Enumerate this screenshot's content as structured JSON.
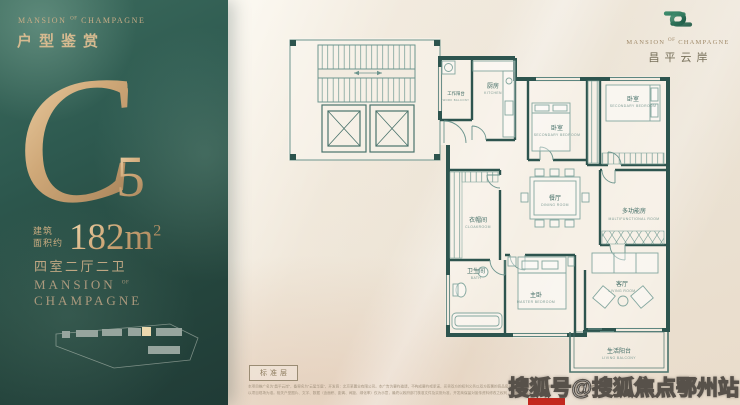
{
  "brand": {
    "left": "MANSION",
    "mid": "OF",
    "right": "CHAMPAGNE"
  },
  "sidebar": {
    "title": "户型鉴赏",
    "unit_letter": "C",
    "unit_number": "5",
    "area_label_line1": "建筑",
    "area_label_line2": "面积约",
    "area_value": "182m",
    "area_sup": "2",
    "layout_desc": "四室二厅二卫"
  },
  "logo": {
    "cn_name": "昌平云岸"
  },
  "floorplan": {
    "type_label": "标准层",
    "rooms": [
      {
        "cn": "工作阳台",
        "en": "WORK BALCONY"
      },
      {
        "cn": "厨房",
        "en": "KITCHEN"
      },
      {
        "cn": "卧室",
        "en": "SECONDARY BEDROOM"
      },
      {
        "cn": "卧室",
        "en": "SECONDARY BEDROOM"
      },
      {
        "cn": "衣帽间",
        "en": "CLOAKROOM"
      },
      {
        "cn": "餐厅",
        "en": "DINING ROOM"
      },
      {
        "cn": "多功能房",
        "en": "MULTIFUNCTIONAL ROOM"
      },
      {
        "cn": "卫生间",
        "en": "BATH"
      },
      {
        "cn": "主卧",
        "en": "MASTER BEDROOM"
      },
      {
        "cn": "客厅",
        "en": "LIVING ROOM"
      },
      {
        "cn": "生活阳台",
        "en": "LIVING BALCONY"
      }
    ]
  },
  "disclaimer": {
    "line1": "本项目推广名为“昌平云岸”，备案名为“云玺华庭”，开发商：北京某置业有限公司。本广告为要约邀请，不构成要约或承诺，买卖双方的权利义务以双方签署的商品房买卖合同及附件等协议为准，本资料所载内容仅供参考。",
    "line2": "以项目现场为准。相关户型图片、文字、数据（含面积、距离、间距、绿化率）仅为示意，最终以政府部门核准文件及实测为准，开发商保留对宣传资料修改之权利，敬请留意最新资料。"
  },
  "watermark": "搜狐号@搜狐焦点鄂州站",
  "colors": {
    "sidebar_green": "#2d5a4f",
    "gold": "#caa87d",
    "plan_teal": "#2d544e",
    "background_cream": "#ece3d6",
    "logo_green": "#2f7a60",
    "red_accent": "#c3281e"
  }
}
